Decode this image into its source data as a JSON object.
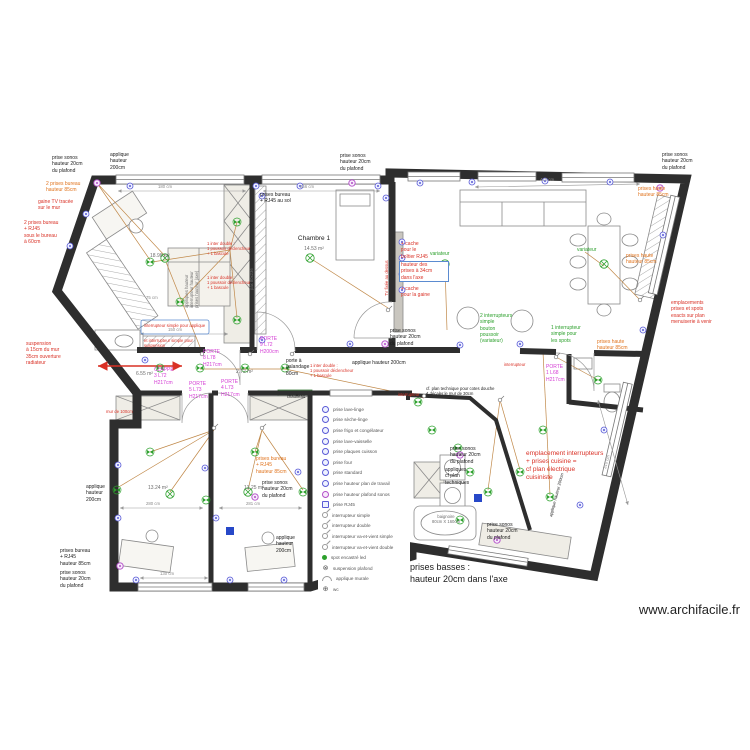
{
  "watermark": "www.archifacile.fr",
  "footer": {
    "text": "prises basses :\nhauteur 20cm dans l'axe"
  },
  "rooms": {
    "chambre1": "Chambre 1",
    "chambre1_area": "14.53 m²",
    "sejour_area": "18.98 m²",
    "sdb_area": "6.55 m²",
    "couloir_area": "2.72 m²",
    "chambre2_area": "13.24 m²",
    "chambre3_area": "13.25 m²"
  },
  "notes": {
    "prise_sonos": "prise sonos\nhauteur 20cm\ndu plafond",
    "applique_200": "applique\nhauteur\n200cm",
    "applique_200_line": "applique hauteur 200cm",
    "deux_prises_bureau_85": "2 prises bureau\nhauteur 85cm",
    "gaine_tv": "gaine TV tracée\nsur le mur",
    "deux_prises_bureau_rj45": "2 prises bureau\n+ RJ45\nsous le bureau\nà 60cm",
    "prises_bureau_rj45_sol": "prises bureau\n+ RJ45 au sol",
    "prises_haute_85": "prises haute\nhauteur 85cm",
    "cache_rj45": "+ cache\npour le\nboîtier RJ45",
    "hauteur_prises_34": "hauteur des\nprises à 34cm\ndans l'axe",
    "cache_gaine": "+ cache\npour la gaine",
    "variateur": "variateur",
    "deux_inter": "2 interrupteurs\nsimple\nbouton\npoussoir\n(variateur)",
    "un_inter_spots": "1 interrupteur\nsimple pour\nles spots",
    "emplacements": "emplacements\nprises et spots\nexacts sur plan\nmenuiserie à venir",
    "inter_applique": "interrupteur simple pour applique",
    "inter_suspension": "et interrupteur simple pour suspension",
    "suspension_radiateur": "suspension\nà 15cm du mur\n35cm ouverture\nradiateur",
    "porte8": "PORTE\n8 L78\nH217cm",
    "clappe3": "CLAPPE\n3 L72\nH217cm",
    "porte5": "PORTE\n5 L73\nH217cm",
    "porte4": "PORTE\n4 L73\nH217cm",
    "porte9": "PORTE\n9 L72\nH200cm",
    "porte1": "PORTE\n1 L68\nH217cm",
    "galandage": "porte à\ngalandage\n80cm",
    "inter_double": "1 inter double :\n1 poussoir déclencheur\n+ 1 bascule",
    "chauffeau": "chauffeau",
    "interrupteur": "interrupteur",
    "plan_technique": "cf. plan technique pour cotes douche\n+ décaler le mur de 30cm",
    "appliques_plan": "appliques\ncf plan\ntechniques",
    "empl_cuisine": "emplacement interrupteurs\n+ prises cuisine =\ncf plan électrique\ncuisiniste",
    "baignoire": "baignoire\n80cm X 160cm",
    "prises_bureau_rj45_85": "prises bureau\n+ RJ45\nhauteur 85cm",
    "mur100": "mur de 100cm",
    "pax": "pax 80x236",
    "tv_fixee": "TV fixée au dessus",
    "cuisine_vert": "appliques hauteur\ninterrupteur hauteur\nprises hauteur (axe)"
  },
  "dims": {
    "d180": "180 cm",
    "d256": "256 cm",
    "d410": "410 cm",
    "d150": "150 cm",
    "d75": "75 cm",
    "d280": "280 cm",
    "d281": "281 cm",
    "d130": "130 cm",
    "d310": "310 cm"
  },
  "legend": {
    "items": [
      {
        "icon": "socket-icon",
        "label": "prise lave-linge"
      },
      {
        "icon": "socket-icon",
        "label": "prise sèche-linge"
      },
      {
        "icon": "socket-icon",
        "label": "prise frigo et congélateur"
      },
      {
        "icon": "socket-icon",
        "label": "prise lave-vaisselle"
      },
      {
        "icon": "socket-icon",
        "label": "prise plaques cuisson"
      },
      {
        "icon": "socket-icon",
        "label": "prise four"
      },
      {
        "icon": "socket-icon",
        "label": "prise standard"
      },
      {
        "icon": "socket-icon",
        "label": "prise hauteur plan de travail"
      },
      {
        "icon": "sonos-socket-icon",
        "label": "prise hauteur plafond sonos"
      },
      {
        "icon": "rj45-icon",
        "label": "prise RJ45"
      },
      {
        "icon": "switch-icon",
        "label": "interrupteur simple"
      },
      {
        "icon": "switch-icon",
        "label": "interrupteur double"
      },
      {
        "icon": "switch-icon",
        "label": "interrupteur va-et-vient simple"
      },
      {
        "icon": "switch-icon",
        "label": "interrupteur va-et-vient double"
      },
      {
        "icon": "led-spot-icon",
        "label": "spot encastré led"
      },
      {
        "icon": "ceiling-light-icon",
        "label": "suspension plafond"
      },
      {
        "icon": "wall-light-icon",
        "label": "applique murale"
      },
      {
        "icon": "wc-icon",
        "label": "wc"
      }
    ]
  },
  "colors": {
    "wall": "#2e2e2e",
    "spot_green": "#2ca02c",
    "socket_blue": "#5b5bd6",
    "sonos_purple": "#b24fc8",
    "door_magenta": "#d43bd4",
    "note_red": "#d93025",
    "note_orange": "#e0731d",
    "trace": "#c08848",
    "dimension": "#8a8a8a"
  }
}
